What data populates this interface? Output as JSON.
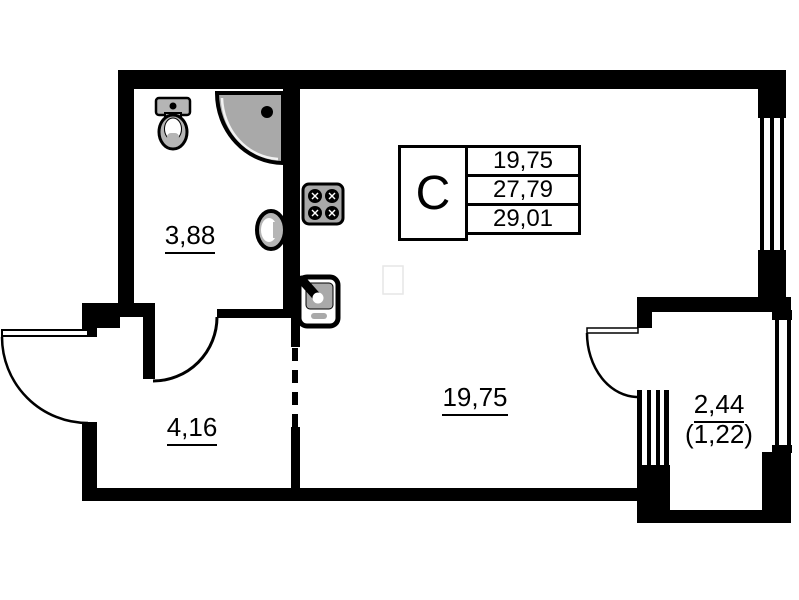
{
  "info_box": {
    "type_letter": "С",
    "values": [
      "19,75",
      "27,79",
      "29,01"
    ]
  },
  "rooms": {
    "bathroom": {
      "area": "3,88"
    },
    "hallway": {
      "area": "4,16"
    },
    "living": {
      "area": "19,75"
    },
    "balcony": {
      "area": "2,44",
      "area_reduced": "(1,22)"
    }
  },
  "fixtures": [
    "toilet",
    "corner-shower",
    "washbasin",
    "stove",
    "kitchen-sink"
  ],
  "colors": {
    "line": "#000000",
    "background": "#ffffff",
    "fixture_gray": "#a9a9a9",
    "fixture_gray_light": "#b5b5b5"
  }
}
